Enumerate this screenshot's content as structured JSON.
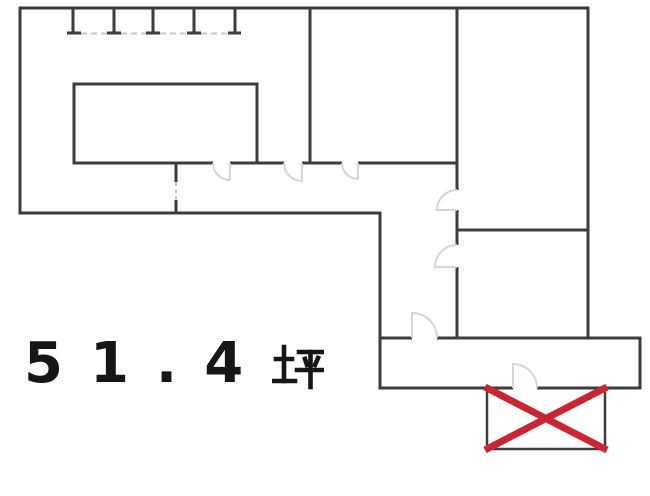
{
  "floor_area": {
    "label_display": "５１．４坪",
    "value": "51.4",
    "unit": "坪"
  },
  "crossed_out_marker": {
    "symbol": "X"
  },
  "colors": {
    "wall": "#3d3d3d",
    "door_arc": "#d6d6d6",
    "light_dash": "#c9c9c9",
    "cross_red": "#cb2532",
    "text": "#161616",
    "background": "#ffffff"
  }
}
